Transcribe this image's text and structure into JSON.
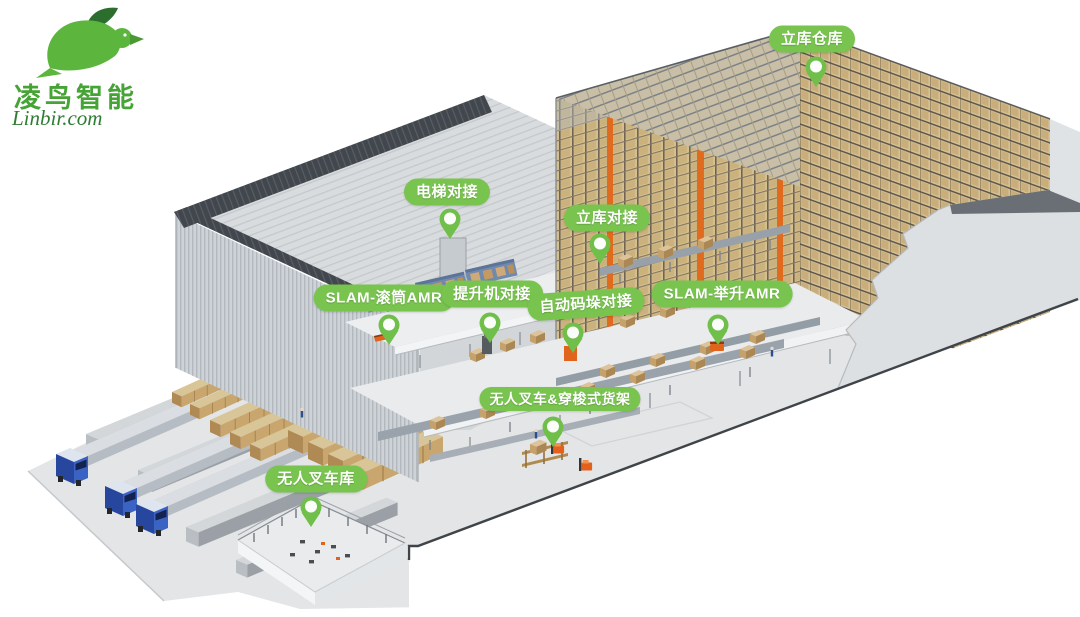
{
  "brand": {
    "name": "凌鸟智能",
    "site": "Linbir.com"
  },
  "callouts": [
    {
      "id": "asrs-warehouse",
      "text": "立库仓库"
    },
    {
      "id": "elevator-docking",
      "text": "电梯对接"
    },
    {
      "id": "asrs-docking",
      "text": "立库对接"
    },
    {
      "id": "slam-roller-amr",
      "text": "SLAM-滚筒AMR"
    },
    {
      "id": "lifter-docking",
      "text": "提升机对接"
    },
    {
      "id": "auto-palletizing-docking",
      "text": "自动码垛对接"
    },
    {
      "id": "slam-lifting-amr",
      "text": "SLAM-举升AMR"
    },
    {
      "id": "unmanned-forklift-shuttle-rack",
      "text": "无人叉车&穿梭式货架"
    },
    {
      "id": "unmanned-forklift-garage",
      "text": "无人叉车库"
    }
  ],
  "colors": {
    "brand_green": "#46a335",
    "brand_dark_green": "#2c6e2e",
    "site_green": "#2e7d33",
    "callout_green": "#79c44f",
    "pin_green": "#6fbf4a",
    "floor_gray": "#e3e5e7",
    "rack_tan": "#d6c194",
    "mast_orange": "#e06a1e",
    "truck_blue": "#27479e",
    "forklift_orange": "#e2611c"
  }
}
